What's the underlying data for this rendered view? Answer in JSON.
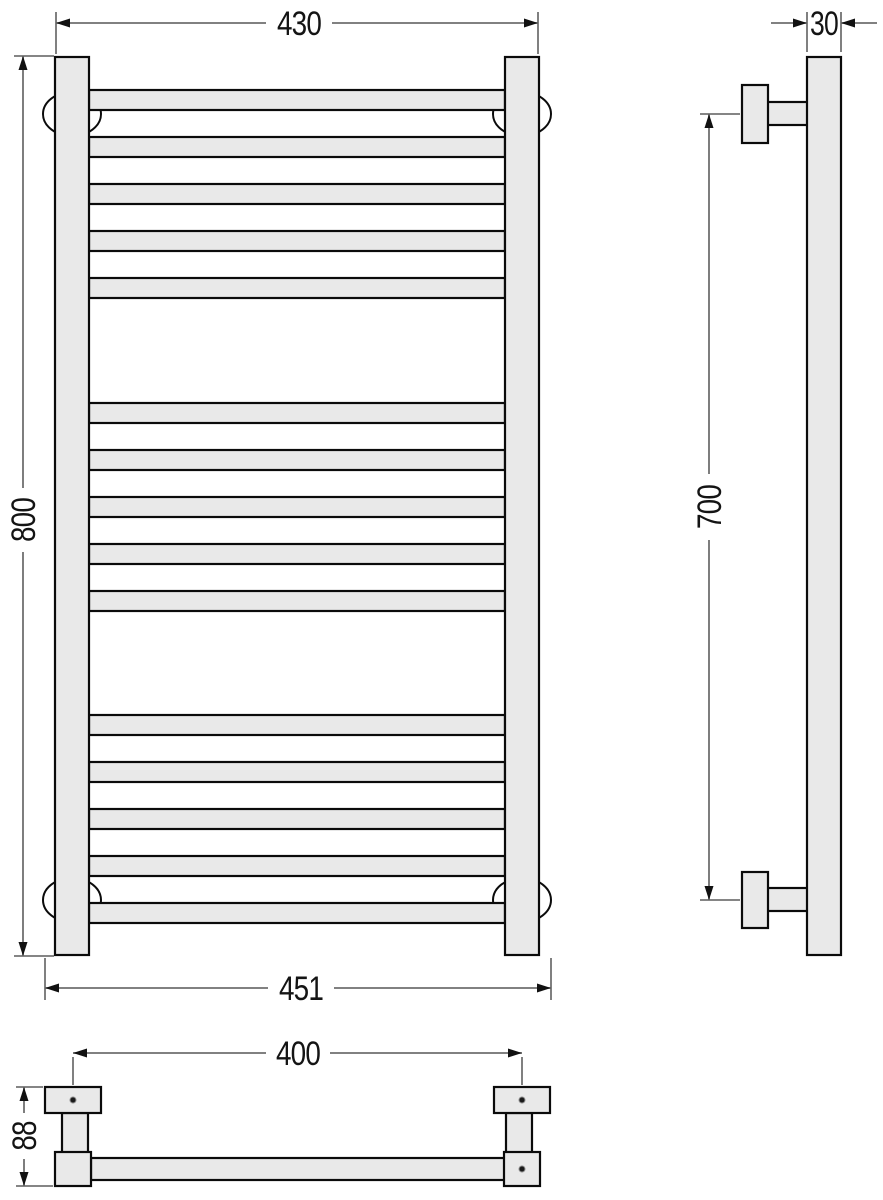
{
  "drawing": {
    "type": "technical-dimension-drawing",
    "subject": "ladder towel rail radiator, three orthographic views (front, side, plan)"
  },
  "dimensions": {
    "front_width_top": "430",
    "front_height": "800",
    "front_width_bottom": "451",
    "side_depth": "30",
    "side_bracket_spacing": "700",
    "plan_hole_spacing": "400",
    "plan_depth": "88"
  },
  "structure": {
    "rung_count": 15,
    "rung_groups": 3,
    "rungs_per_group": 5,
    "wall_bracket_count": 4
  },
  "colors": {
    "part_fill": "#e9e9e9",
    "bracket_fill": "#ffffff",
    "outline": "#0b0b0b",
    "dimension_line": "#6f6f6f",
    "extension_line": "#3c3c3c",
    "text": "#141414",
    "background": "#ffffff"
  }
}
